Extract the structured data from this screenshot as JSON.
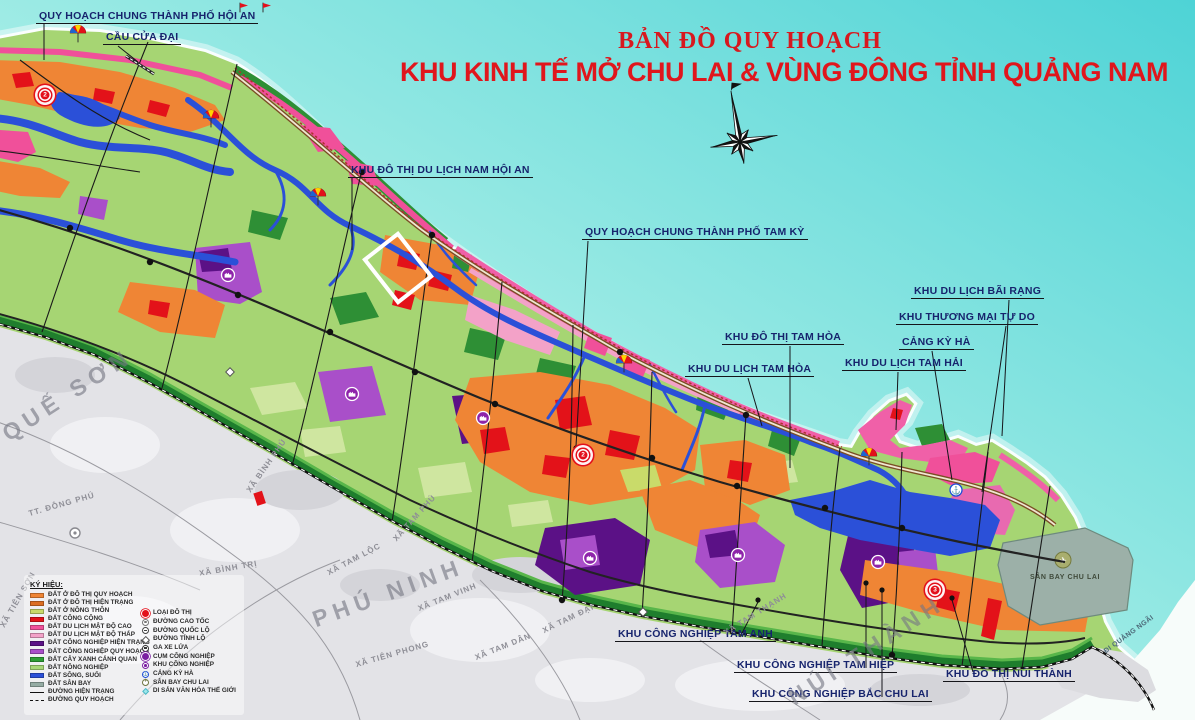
{
  "title": {
    "line1": "BẢN ĐỒ QUY HOẠCH",
    "line2": "KHU KINH TẾ MỞ CHU LAI & VÙNG ĐÔNG TỈNH QUẢNG NAM"
  },
  "callouts": [
    {
      "label": "QUY HOẠCH CHUNG THÀNH PHỐ HỘI AN"
    },
    {
      "label": "CẦU CỬA ĐẠI"
    },
    {
      "label": "KHU ĐÔ THỊ DU LỊCH NAM HỘI AN"
    },
    {
      "label": "QUY HOẠCH CHUNG THÀNH PHỐ TAM KỲ"
    },
    {
      "label": "KHU ĐÔ THỊ TAM HÒA"
    },
    {
      "label": "KHU DU LỊCH TAM HÒA"
    },
    {
      "label": "KHU DU LỊCH TAM HẢI"
    },
    {
      "label": "CẢNG KỲ HÀ"
    },
    {
      "label": "KHU THƯƠNG MẠI TỰ DO"
    },
    {
      "label": "KHU DU LỊCH BÃI RẠNG"
    },
    {
      "label": "KHU CÔNG NGHIỆP TAM ANH"
    },
    {
      "label": "KHU CÔNG NGHIỆP TAM HIỆP"
    },
    {
      "label": "KHU CÔNG NGHIỆP BẮC CHU LAI"
    },
    {
      "label": "KHU ĐÔ THỊ NÚI THÀNH"
    }
  ],
  "markers": [
    {
      "value": "2"
    },
    {
      "value": "2"
    },
    {
      "value": "3"
    }
  ],
  "map_labels": {
    "airport": "SÂN BAY CHU LAI",
    "to_quang_ngai": "ĐI QUẢNG NGÃI"
  },
  "places": {
    "districts": [
      "QUẾ SƠN",
      "PHÚ NINH",
      "NÚI THÀNH"
    ],
    "communes": [
      "XÃ TAM LỘC",
      "XÃ TAM VINH",
      "XÃ TIÊN PHONG",
      "XÃ TAM DÂN",
      "XÃ TAM ĐẠI",
      "XÃ TAM THẠNH",
      "TT. ĐÔNG PHÚ",
      "XÃ BÌNH PHÚ",
      "XÃ BÌNH TRỊ",
      "XÃ TIÊN SƠN",
      "XÃ TAM PHÚ"
    ]
  },
  "legend": {
    "title": "KÝ HIỆU:",
    "areas": [
      {
        "label": "ĐẤT Ở ĐÔ THỊ QUY HOẠCH",
        "color": "#EF8535"
      },
      {
        "label": "ĐẤT Ở ĐÔ THỊ HIỆN TRẠNG",
        "color": "#DC6E22"
      },
      {
        "label": "ĐẤT Ở NÔNG THÔN",
        "color": "#C9DB6A"
      },
      {
        "label": "ĐẤT CÔNG CỘNG",
        "color": "#E31219"
      },
      {
        "label": "ĐẤT DU LỊCH MẬT ĐỘ CAO",
        "color": "#F0509A"
      },
      {
        "label": "ĐẤT DU LỊCH MẬT ĐỘ THẤP",
        "color": "#F3A2C8"
      },
      {
        "label": "ĐẤT CÔNG NGHIỆP HIỆN TRẠNG",
        "color": "#5B1186"
      },
      {
        "label": "ĐẤT CÔNG NGHIỆP QUY HOẠCH",
        "color": "#A94FC9"
      },
      {
        "label": "ĐẤT CÂY XANH CẢNH QUAN",
        "color": "#2E9E35"
      },
      {
        "label": "ĐẤT NÔNG NGHIỆP",
        "color": "#A8D878"
      },
      {
        "label": "ĐẤT SÔNG, SUỐI",
        "color": "#2B50D8"
      },
      {
        "label": "ĐẤT SÂN BAY",
        "color": "#95ACA4"
      }
    ],
    "lines": [
      {
        "label": "ĐƯỜNG HIỆN TRẠNG",
        "style": "solid"
      },
      {
        "label": "ĐƯỜNG QUY HOẠCH",
        "style": "dashed"
      }
    ],
    "symbols": [
      {
        "label": "LOẠI ĐÔ THỊ",
        "icon": "city-marker"
      },
      {
        "label": "ĐƯỜNG CAO TỐC",
        "icon": "expressway"
      },
      {
        "label": "ĐƯỜNG QUỐC LỘ",
        "icon": "national-road"
      },
      {
        "label": "ĐƯỜNG TỈNH LỘ",
        "icon": "provincial-road"
      },
      {
        "label": "GA XE LỬA",
        "icon": "train-station"
      },
      {
        "label": "CỤM CÔNG NGHIỆP",
        "icon": "industrial-cluster"
      },
      {
        "label": "KHU CÔNG NGHIỆP",
        "icon": "industrial-zone"
      },
      {
        "label": "CẢNG KỲ HÀ",
        "icon": "port"
      },
      {
        "label": "SÂN BAY CHU LAI",
        "icon": "airport"
      },
      {
        "label": "DI SẢN VĂN HÓA THẾ GIỚI",
        "icon": "world-heritage"
      }
    ]
  },
  "colors": {
    "title_red": "#E0161C",
    "sea_deep": "#4ED3D6",
    "sea_pale": "#D7F7F2",
    "agriculture": "#A6D573",
    "terrain_gray": "#E3E3E7",
    "boundary_green": "#1F7E2D",
    "river_blue": "#2B50D8",
    "callout_navy": "#17246D"
  }
}
